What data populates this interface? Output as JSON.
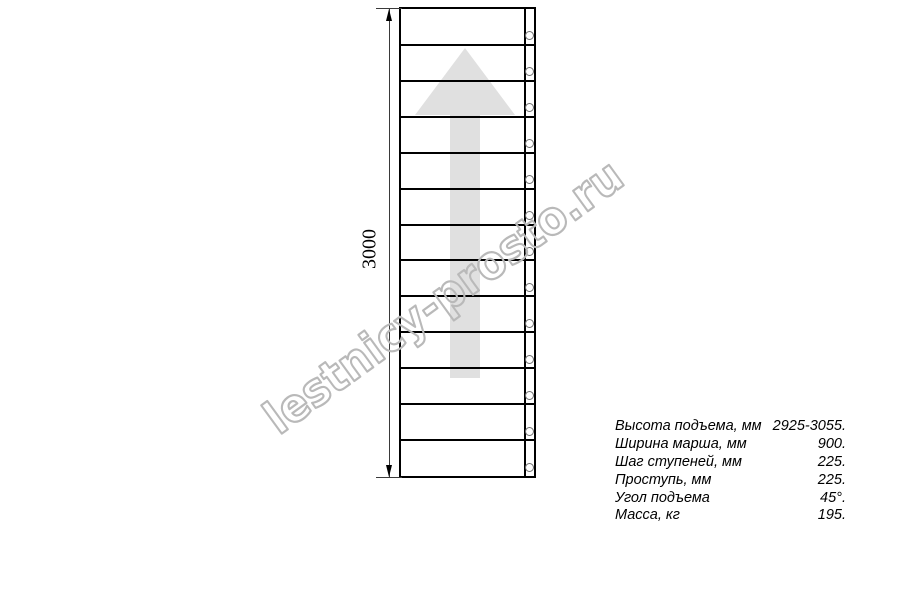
{
  "watermark": {
    "text": "lestnicy-prosto.ru",
    "color": "#b9b9b9"
  },
  "drawing": {
    "dimension_label": "3000",
    "steps_count": 13,
    "bolts_count": 13,
    "arrow_color": "#e0e0e0",
    "line_color": "#000000"
  },
  "specs": {
    "rows": [
      {
        "label": "Высота подъема, мм",
        "value": "2925-3055."
      },
      {
        "label": "Ширина марша, мм",
        "value": "900."
      },
      {
        "label": "Шаг ступеней, мм",
        "value": "225."
      },
      {
        "label": "Проступь, мм",
        "value": "225."
      },
      {
        "label": "Угол подъема",
        "value": "45°."
      },
      {
        "label": "Масса, кг",
        "value": "195."
      }
    ]
  }
}
